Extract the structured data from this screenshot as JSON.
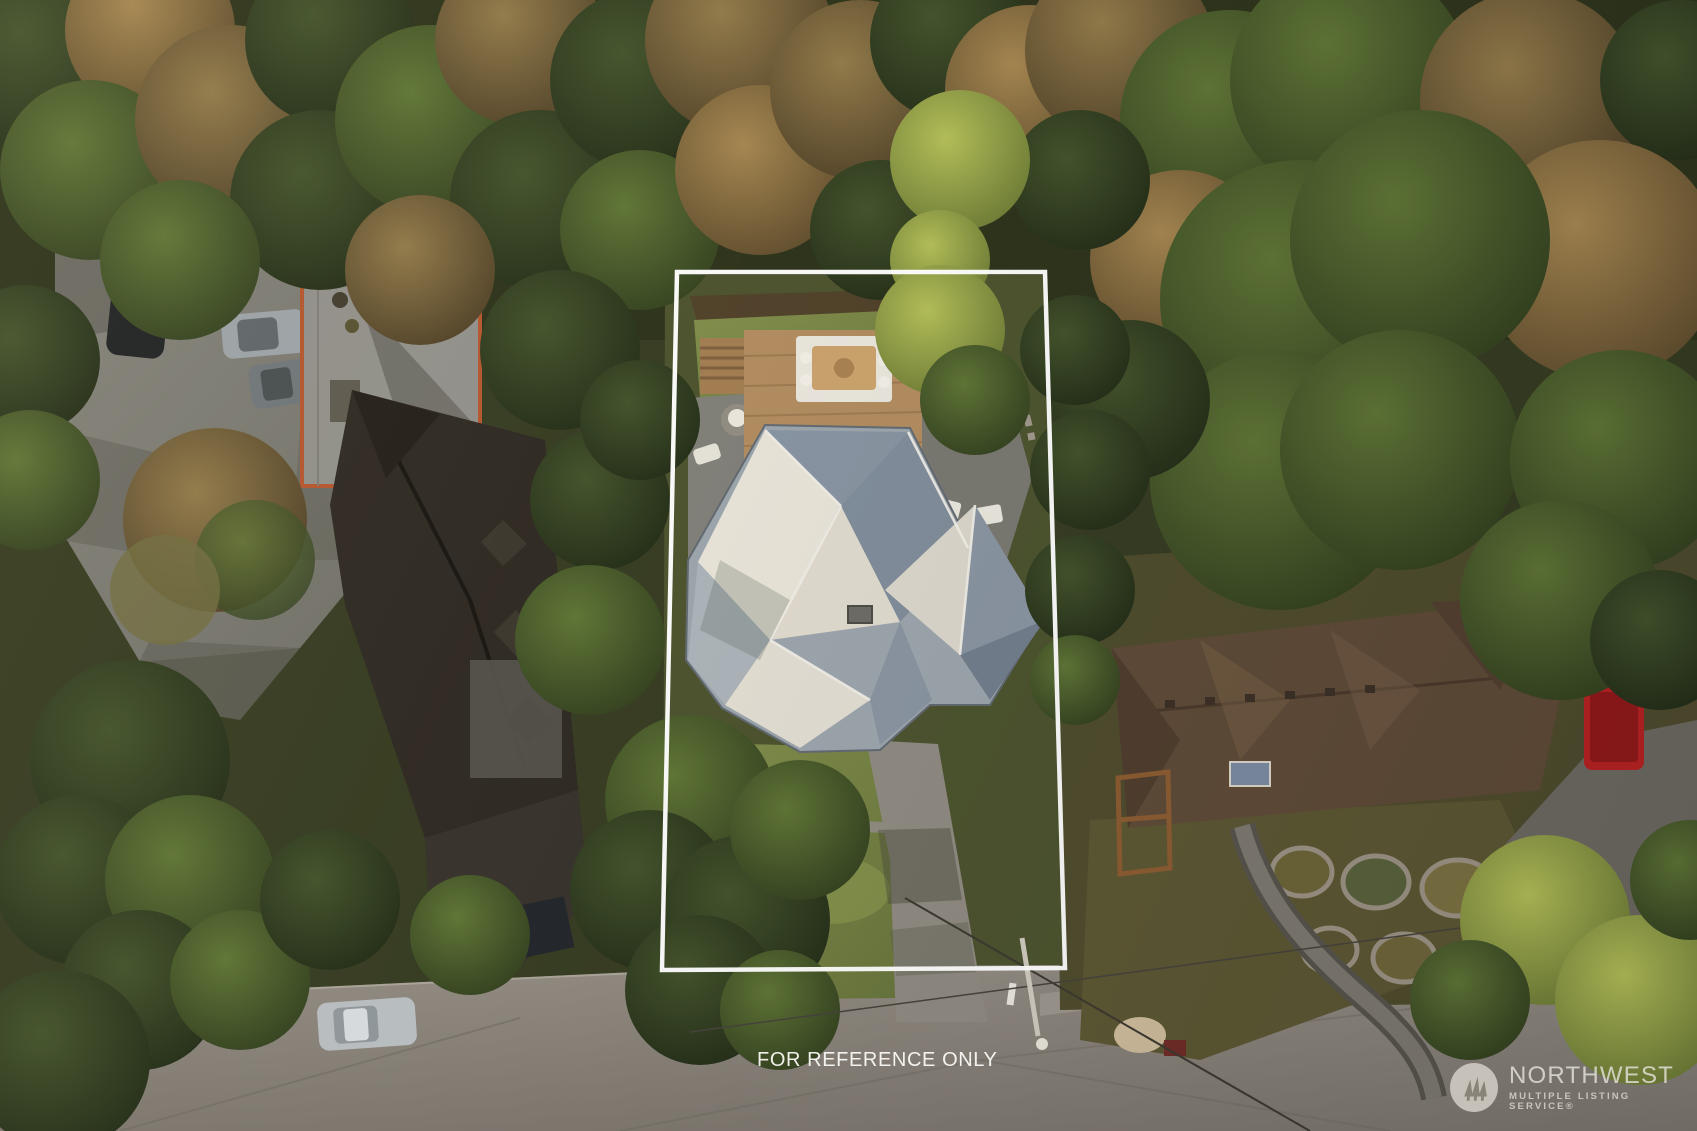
{
  "overlay": {
    "reference_text": "FOR REFERENCE ONLY",
    "boundary_color": "#ffffff"
  },
  "watermark": {
    "brand": "NORTHWEST",
    "tagline": "MULTIPLE LISTING SERVICE®",
    "logo_icon": "pine-trees-icon",
    "logo_color": "#dbd7ce",
    "logo_tree_color": "#8b857a"
  },
  "palette": {
    "boundary": "#ffffff",
    "forest_dark": "#2a331c",
    "forest_mid": "#46542a",
    "forest_bright": "#9aa94e",
    "bare_branch_brown": "#8a714a",
    "road": "#8a847b",
    "driveway": "#8d8880",
    "lawn": "#77843f",
    "deck_wood": "#b08a5e",
    "subject_roof_light": "#e6e2d7",
    "subject_roof_shade": "#8592a0",
    "left_neighbor_roof": "#2c2721",
    "right_neighbor_roof": "#5d4836",
    "red_truck": "#b62020",
    "roof_deck_rail_accent": "#b2542c"
  }
}
